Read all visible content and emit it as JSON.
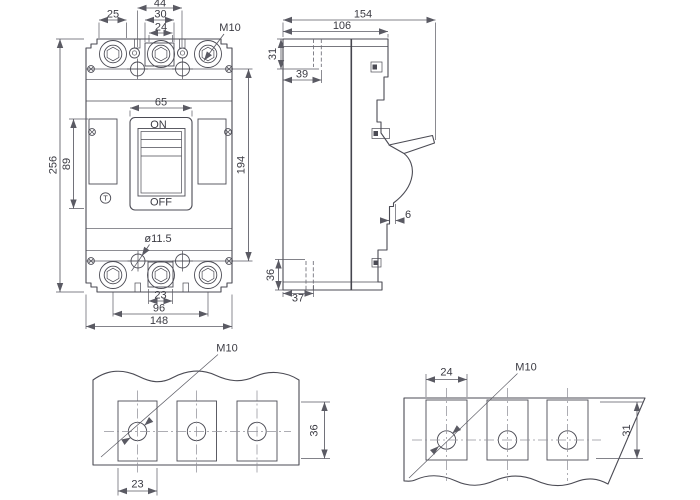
{
  "front": {
    "d25": "25",
    "d44": "44",
    "d30": "30",
    "d24": "24",
    "m10": "M10",
    "d65": "65",
    "on": "ON",
    "off": "OFF",
    "trip": "T",
    "d256": "256",
    "d89": "89",
    "d194": "194",
    "hole_dia": "ø11.5",
    "d23": "23",
    "d96": "96",
    "d148": "148"
  },
  "side": {
    "d154": "154",
    "d106": "106",
    "d31": "31",
    "d39": "39",
    "d6": "6",
    "d36": "36",
    "d37": "37"
  },
  "detail_bottom_left": {
    "m10": "M10",
    "d23": "23",
    "d36": "36"
  },
  "detail_bottom_right": {
    "d24": "24",
    "m10": "M10",
    "d31": "31"
  }
}
